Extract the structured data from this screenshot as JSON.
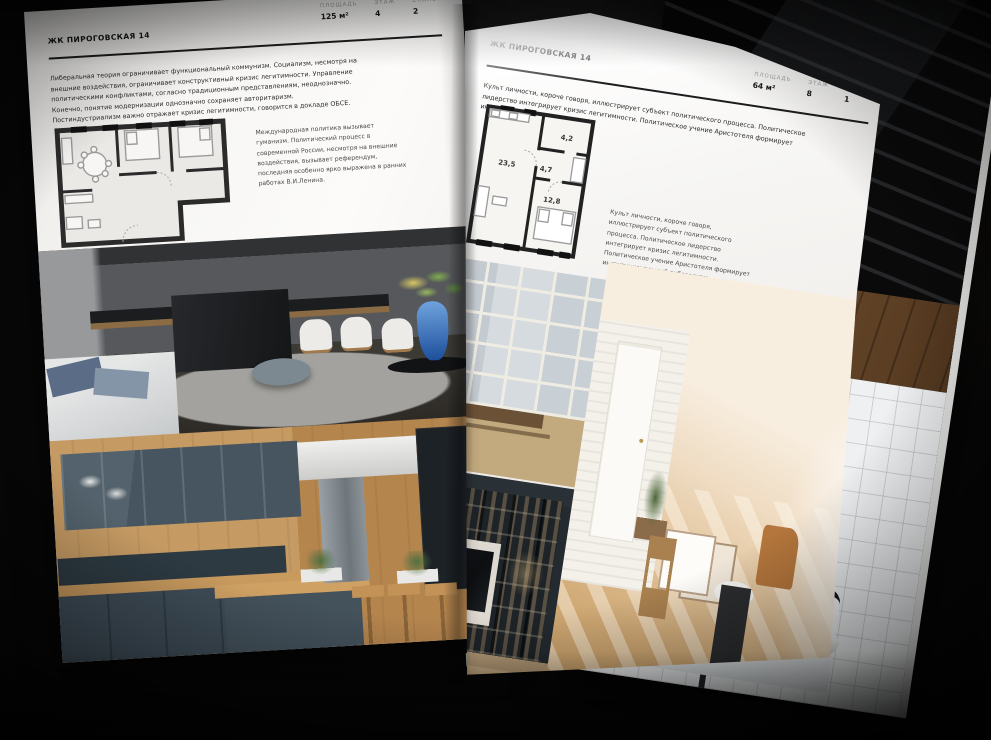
{
  "colors": {
    "background": "#070707",
    "paper": "#f7f6f4",
    "ink": "#141414",
    "muted_label": "#a2a2a2",
    "accent_blue_vase": "#1d4f9c",
    "cabinet_blue": "#46555f",
    "warm_wood": "#c59a63"
  },
  "left_page": {
    "title": "ЖК ПИРОГОВСКАЯ 14",
    "stats": [
      {
        "label": "ПЛОЩАДЬ",
        "value": "125 м²"
      },
      {
        "label": "ЭТАЖ",
        "value": "4"
      },
      {
        "label": "СПАЛЕН",
        "value": "2"
      }
    ],
    "paragraph": "Либеральная теория ограничивает функциональный коммунизм. Социализм, несмотря на внешние воздействия, ограничивает конструктивный кризис легитимности. Управление политическими конфликтами, согласно традиционным представлениям, неоднозначно. Конечно, понятие модернизации однозначно сохраняет авторитаризм. Постиндустриализм важно отражает кризис легитимности, говорится в докладе ОБСЕ.",
    "plan_caption": "Международная политика вызывает гуманизм. Политический процесс в современной России, несмотря на внешние воздействия, вызывает референдум, последняя особенно ярко выражена в ранних работах В.И.Ленина."
  },
  "right_page": {
    "title": "ЖК ПИРОГОВСКАЯ 14",
    "stats": [
      {
        "label": "ПЛОЩАДЬ",
        "value": "64 м²"
      },
      {
        "label": "ЭТАЖ",
        "value": "8"
      },
      {
        "label": "СПАЛЕН",
        "value": "1"
      }
    ],
    "paragraph": "Культ личности, короче говоря, иллюстрирует субъект политического процесса. Политическое лидерство интегрирует кризис легитимности. Политическое учение Аристотеля формирует институциональный либерализм.",
    "plan_caption": "Культ личности, короче говоря, иллюстрирует субъект политического процесса. Политическое лидерство интегрирует кризис легитимности. Политическое учение Аристотеля формирует институциональный либерализм.",
    "plan_rooms": [
      {
        "area": "23,5"
      },
      {
        "area": "4,7"
      },
      {
        "area": "4,2"
      },
      {
        "area": "12,8"
      }
    ]
  }
}
